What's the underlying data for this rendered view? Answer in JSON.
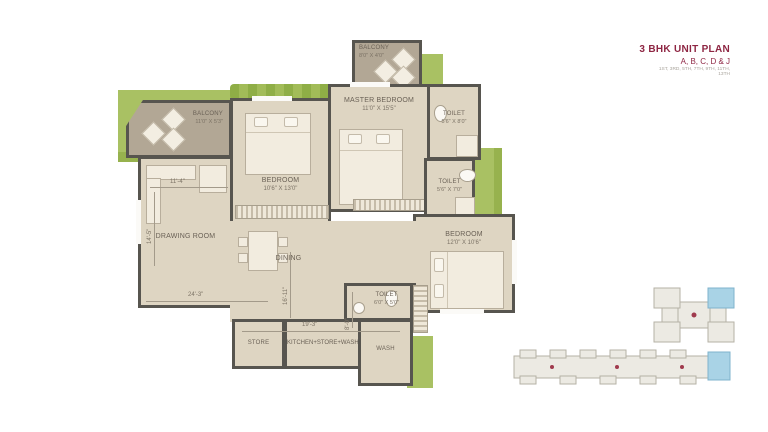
{
  "title_block": {
    "title": "3 BHK UNIT PLAN",
    "subtitle": "A, B, C, D & J",
    "floors": "1ST, 3RD, 5TH, 7TH, 9TH, 11TH, 13TH"
  },
  "rooms": [
    {
      "label": "BALCONY",
      "dim": "8'0\" X 4'0\""
    },
    {
      "label": "BALCONY",
      "dim": "11'0\" X 5'3\""
    },
    {
      "label": "MASTER BEDROOM",
      "dim": "11'0\" X 15'5\""
    },
    {
      "label": "TOILET",
      "dim": "5'6\" X 8'0\""
    },
    {
      "label": "TOILET",
      "dim": "5'6\" X 7'0\""
    },
    {
      "label": "BEDROOM",
      "dim": "10'6\" X 13'0\""
    },
    {
      "label": "BEDROOM",
      "dim": "12'0\" X 10'6\""
    },
    {
      "label": "DRAWING ROOM",
      "dim": ""
    },
    {
      "label": "DINING",
      "dim": ""
    },
    {
      "label": "TOILET",
      "dim": "6'0\" X 5'0\""
    },
    {
      "label": "STORE",
      "dim": ""
    },
    {
      "label": "KITCHEN+STORE+WASH",
      "dim": ""
    },
    {
      "label": "WASH",
      "dim": ""
    }
  ],
  "dimensions": {
    "drawing_width": "11'-4\"",
    "drawing_height": "14'-5\"",
    "bottom_width": "24'-3\"",
    "dining_height": "16'-11\"",
    "kitchen_width": "19'-3\"",
    "wash_height": "8'-0\""
  },
  "colors": {
    "accent_maroon": "#8e2643",
    "floor_beige": "#ded5c2",
    "wall_gray": "#57554f",
    "landscape_green": "#a9c163",
    "balcony_taupe": "#b2a795",
    "keyplan_highlight_blue": "#a9d3e6",
    "keyplan_dot_red": "#a03b4e"
  }
}
